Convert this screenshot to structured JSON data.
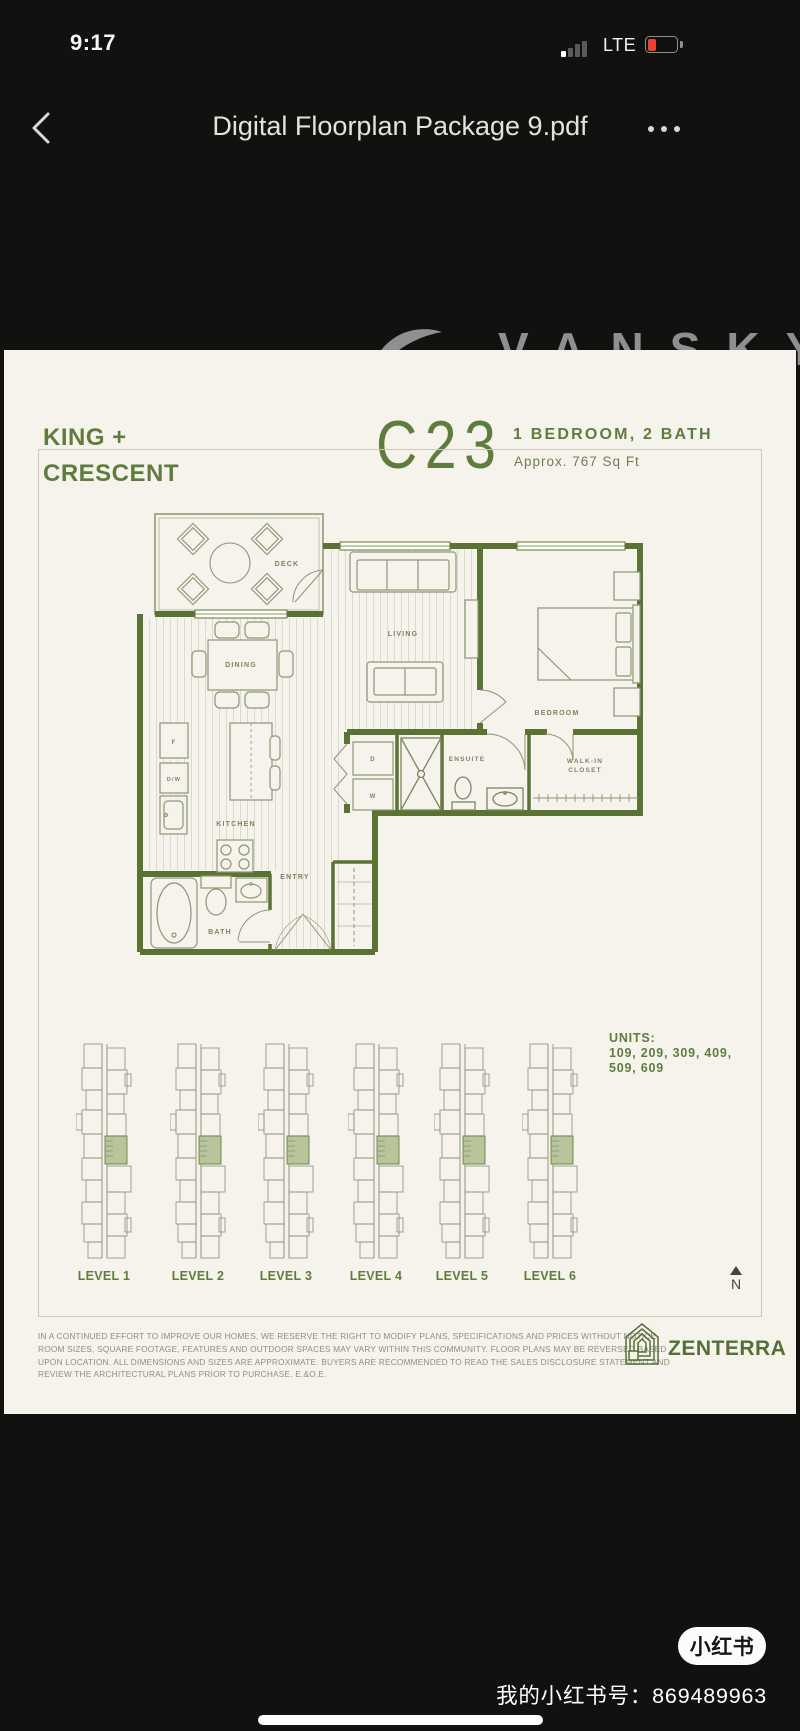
{
  "status_bar": {
    "time": "9:17",
    "network": "LTE",
    "battery_level": "low"
  },
  "nav_bar": {
    "title": "Digital Floorplan Package 9.pdf"
  },
  "watermark": {
    "text": "VANSKY"
  },
  "doc": {
    "brand_line1": "KING +",
    "brand_line2": "CRESCENT",
    "plan_code": "C23",
    "plan_spec": "1 BEDROOM, 2 BATH",
    "plan_area": "Approx. 767 Sq Ft",
    "rooms": {
      "deck": "DECK",
      "living": "LIVING",
      "dining": "DINING",
      "bedroom": "BEDROOM",
      "kitchen": "KITCHEN",
      "ensuite": "ENSUITE",
      "walkin_line1": "WALK-IN",
      "walkin_line2": "CLOSET",
      "entry": "ENTRY",
      "bath": "BATH"
    },
    "fixtures": {
      "fridge": "F",
      "dishwasher": "D/W",
      "dryer": "D",
      "washer": "W"
    },
    "units_label": "UNITS:",
    "units_line1": "109, 209, 309, 409,",
    "units_line2": "509, 609",
    "levels": [
      {
        "label": "LEVEL 1"
      },
      {
        "label": "LEVEL 2"
      },
      {
        "label": "LEVEL 3"
      },
      {
        "label": "LEVEL 4"
      },
      {
        "label": "LEVEL 5"
      },
      {
        "label": "LEVEL 6"
      }
    ],
    "north_label": "N",
    "disclaimer": [
      "IN A CONTINUED EFFORT TO IMPROVE OUR HOMES, WE RESERVE THE RIGHT TO MODIFY PLANS, SPECIFICATIONS AND PRICES WITHOUT NOTICE.",
      "ROOM SIZES, SQUARE FOOTAGE, FEATURES AND OUTDOOR SPACES MAY VARY WITHIN THIS COMMUNITY. FLOOR PLANS MAY BE REVERSED BASED",
      "UPON LOCATION. ALL DIMENSIONS AND SIZES ARE APPROXIMATE. BUYERS ARE RECOMMENDED TO READ THE SALES DISCLOSURE STATEMENT AND",
      "REVIEW THE ARCHITECTURAL PLANS PRIOR TO PURCHASE. E.&O.E."
    ],
    "builder": "ZENTERRA"
  },
  "overlay": {
    "badge": "小红书",
    "account_line": "我的小红书号：869489963"
  },
  "colors": {
    "brand_green": "#5f7c3e",
    "wall_green": "#5a7335",
    "battery_red": "#ec4136",
    "page_bg": "#f5f3ec",
    "watermark_gray": "#8f8f8f",
    "highlight_green": "#b8c49a"
  }
}
